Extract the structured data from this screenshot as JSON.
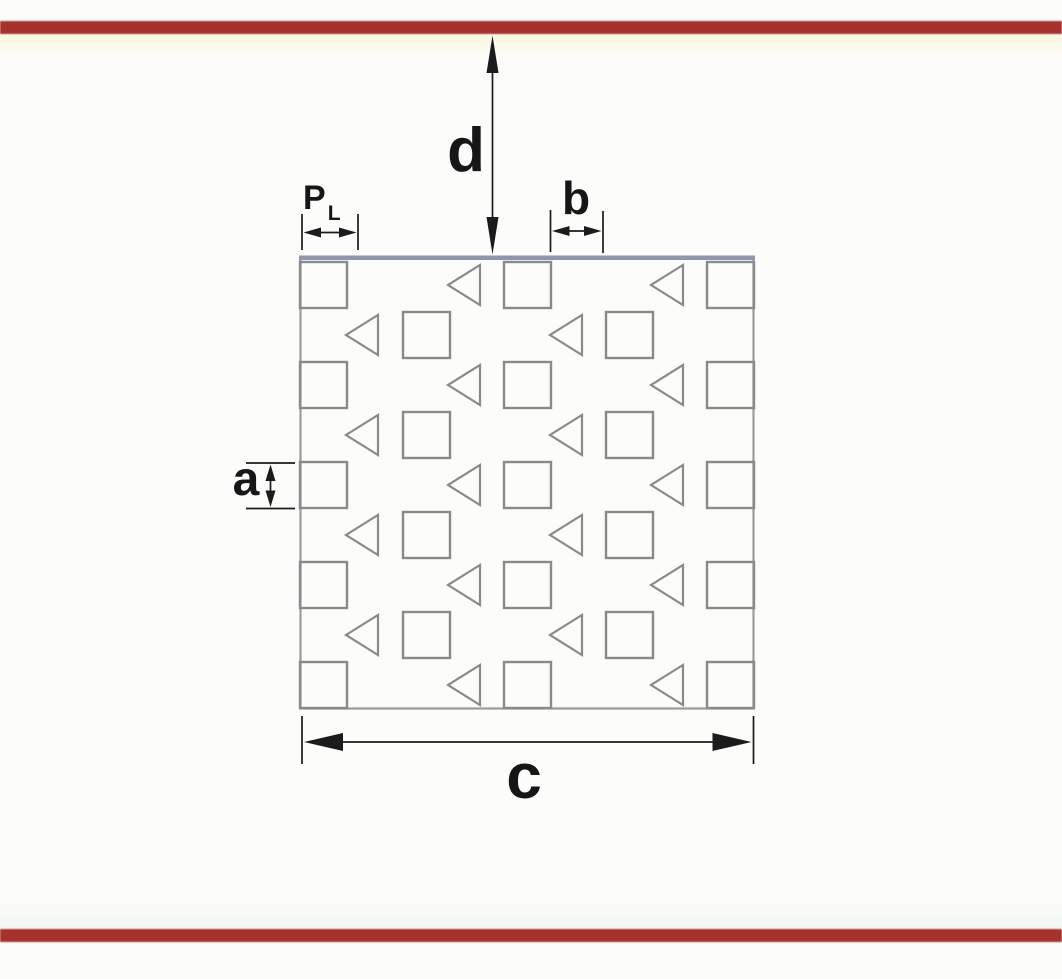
{
  "colors": {
    "background": "#fcfcfa",
    "wall_line": "#a5302c",
    "plate_top_edge": "#9196ac",
    "pattern_stroke": "#8a8a8a",
    "boundary_stroke": "#9b9b9b",
    "dimension": "#1b1b1b"
  },
  "labels": {
    "d": "d",
    "p_main": "P",
    "p_sub": "L",
    "b": "b",
    "a": "a",
    "c": "c"
  },
  "pattern": {
    "plate": {
      "x": 300,
      "y": 258,
      "width": 454,
      "height": 451
    },
    "square": {
      "width": 47,
      "height": 46
    },
    "triangle": {
      "width": 32,
      "height": 40,
      "dy": 3,
      "direction": "left"
    },
    "row_y": [
      262,
      312,
      362,
      412,
      462,
      512,
      562,
      612,
      662
    ],
    "row_types": [
      "edge",
      "offset",
      "edge",
      "offset",
      "edge",
      "offset",
      "edge",
      "offset",
      "edge"
    ],
    "edge_row": {
      "squares_x": [
        300,
        504,
        707
      ],
      "triangles_x": [
        448,
        651
      ]
    },
    "offset_row": {
      "squares_x": [
        403,
        606
      ],
      "triangles_x": [
        346,
        550
      ]
    }
  }
}
